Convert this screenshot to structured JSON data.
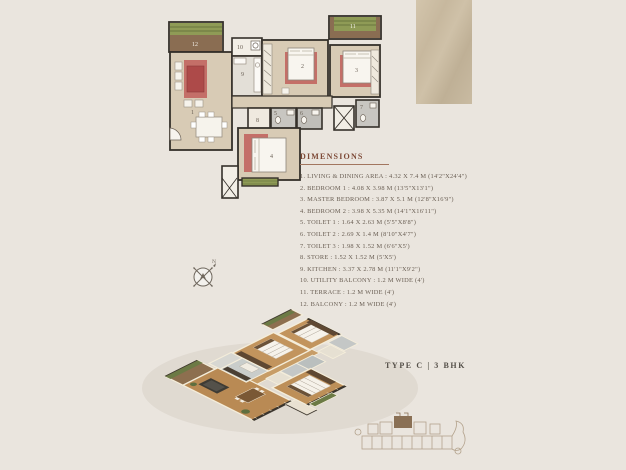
{
  "page": {
    "background": "#eae5de",
    "accent_tan": "#c7b89e"
  },
  "dimensions_panel": {
    "title": "DIMENSIONS",
    "items": [
      "1. LIVING & DINING AREA : 4.32 X 7.4 M (14'2\"X24'4\")",
      "2. BEDROOM 1 : 4.08 X 3.98 M (13'5\"X13'1\")",
      "3. MASTER BEDROOM : 3.87 X 5.1 M (12'8\"X16'9\")",
      "4. BEDROOM 2 : 3.98 X 5.35 M (14'1\"X16'11\")",
      "5. TOILET 1 : 1.64 X 2.63 M (5'5\"X8'8\")",
      "6. TOILET 2 : 2.69 X 1.4 M (8'10\"X4'7\")",
      "7. TOILET 3 : 1.98 X 1.52 M (6'6\"X5')",
      "8. STORE : 1.52 X 1.52 M (5'X5')",
      "9. KITCHEN : 3.37 X 2.78 M (11'1\"X9'2\")",
      "10. UTILITY BALCONY : 1.2 M WIDE (4')",
      "11. TERRACE : 1.2 M WIDE (4')",
      "12. BALCONY : 1.2 M WIDE (4')"
    ]
  },
  "unit": {
    "type_label": "TYPE C | 3 BHK"
  },
  "compass": {
    "north": "N"
  },
  "plan2d": {
    "room_labels": [
      {
        "n": "1"
      },
      {
        "n": "2"
      },
      {
        "n": "3"
      },
      {
        "n": "4"
      },
      {
        "n": "5"
      },
      {
        "n": "6"
      },
      {
        "n": "7"
      },
      {
        "n": "8"
      },
      {
        "n": "9"
      },
      {
        "n": "10"
      },
      {
        "n": "11"
      },
      {
        "n": "12"
      }
    ]
  },
  "colors": {
    "wall": "#35302a",
    "floor_beige": "#d8cbb5",
    "accent_red": "#c46f68",
    "sofa_red": "#ad4a49",
    "planter_green": "#8f9b56",
    "deck_brown": "#8a6d52",
    "tile_gray": "#c8c6c1",
    "wood_3d": "#bd8f58",
    "heading_maroon": "#7d4936"
  }
}
